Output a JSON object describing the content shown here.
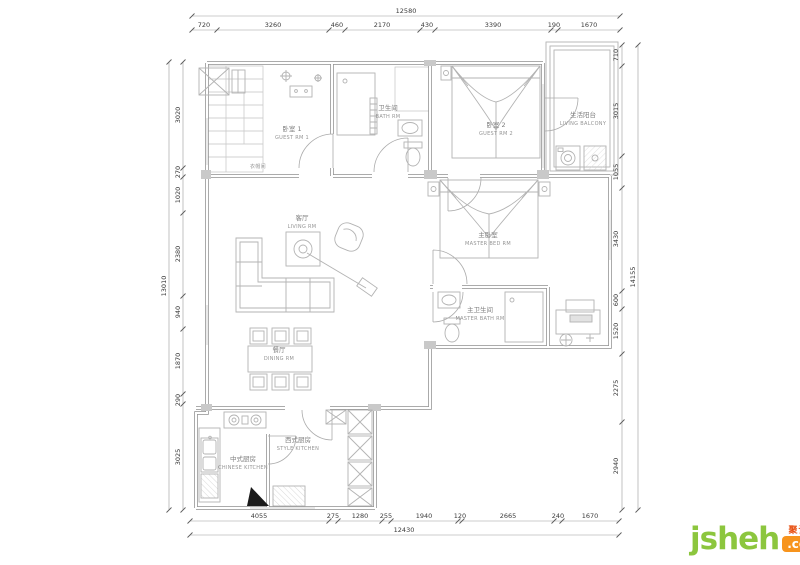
{
  "meta": {
    "drawing_type": "apartment floor plan",
    "background": "#ffffff",
    "wall_color": "#8f8f8f",
    "furniture_color": "#b3b3b3",
    "dim_text_color": "#3a3a3a"
  },
  "dims": {
    "top": {
      "total": "12580",
      "segments": [
        "720",
        "3260",
        "460",
        "2170",
        "430",
        "3390",
        "190",
        "1670"
      ]
    },
    "bottom": {
      "total": "12430",
      "segments": [
        "4055",
        "275",
        "1280",
        "255",
        "1940",
        "120",
        "2665",
        "240",
        "1670"
      ]
    },
    "left": {
      "total": "13010",
      "segments": [
        "3020",
        "270",
        "1020",
        "2380",
        "940",
        "1870",
        "290",
        "3025"
      ]
    },
    "right": {
      "total": "14155",
      "segments": [
        "710",
        "3015",
        "1055",
        "3430",
        "600",
        "1520",
        "2275",
        "2940"
      ]
    }
  },
  "rooms": [
    {
      "id": "guest-rm-1",
      "zh": "卧室 1",
      "en": "GUEST RM 1"
    },
    {
      "id": "bath-rm",
      "zh": "卫生间",
      "en": "BATH RM"
    },
    {
      "id": "guest-rm-2",
      "zh": "卧室 2",
      "en": "GUEST RM 2"
    },
    {
      "id": "living-balcony",
      "zh": "生活阳台",
      "en": "LIVING BALCONY"
    },
    {
      "id": "master-bed-rm",
      "zh": "主卧室",
      "en": "MASTER BED RM"
    },
    {
      "id": "master-bath-rm",
      "zh": "主卫生间",
      "en": "MASTER BATH RM"
    },
    {
      "id": "living-rm",
      "zh": "客厅",
      "en": "LIVING RM"
    },
    {
      "id": "dining-rm",
      "zh": "餐厅",
      "en": "DINING RM"
    },
    {
      "id": "chinese-kitchen",
      "zh": "中式厨房",
      "en": "CHINESE KITCHEN"
    },
    {
      "id": "style-kitchen",
      "zh": "西式厨房",
      "en": "STYLE KITCHEN"
    },
    {
      "id": "cloakroom",
      "zh": "衣帽间",
      "en": ""
    }
  ],
  "logo": {
    "word": "jsheh",
    "tld": ".com",
    "cn": "聚设汇",
    "green": "#8cc63e",
    "orange": "#f7941d",
    "red": "#e84e0f"
  }
}
